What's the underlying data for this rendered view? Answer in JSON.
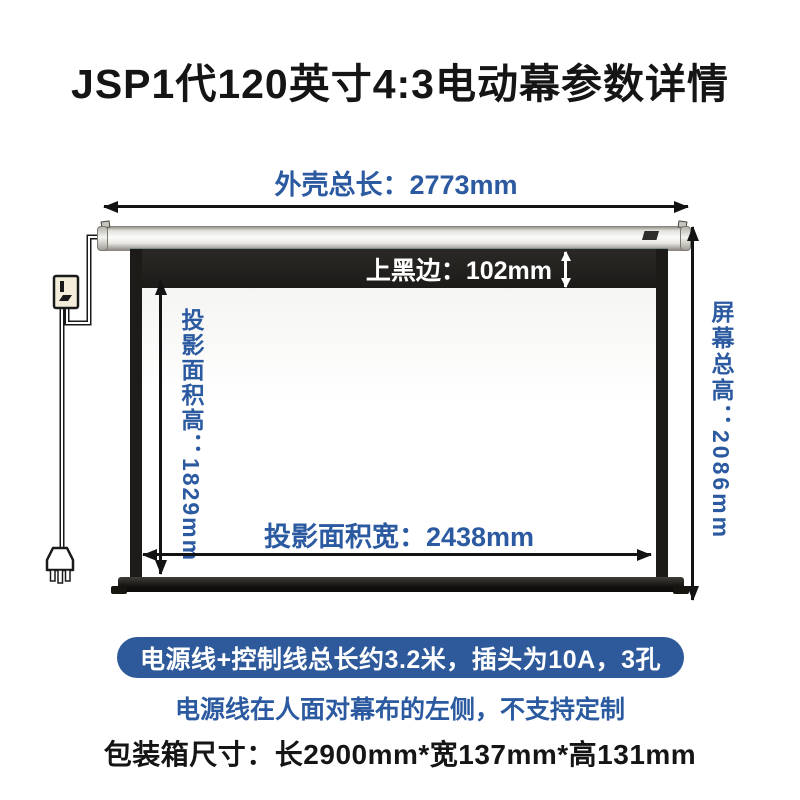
{
  "title": "JSP1代120英寸4:3电动幕参数详情",
  "colors": {
    "accent_blue": "#2B5AA0",
    "pill_bg": "#2E5A9B",
    "frame_black": "#1D1B18"
  },
  "diagram": {
    "casing_length_label": "外壳总长：2773mm",
    "top_black_border_label": "上黑边：102mm",
    "projection_height_label": "投影面积高：1829mm",
    "projection_width_label": "投影面积宽：2438mm",
    "screen_total_height_label": "屏幕总高：2086mm"
  },
  "notes": {
    "cable_pill": "电源线+控制线总长约3.2米，插头为10A，3孔",
    "cable_side_note": "电源线在人面对幕布的左侧，不支持定制",
    "package_size": "包装箱尺寸：长2900mm*宽137mm*高131mm"
  }
}
